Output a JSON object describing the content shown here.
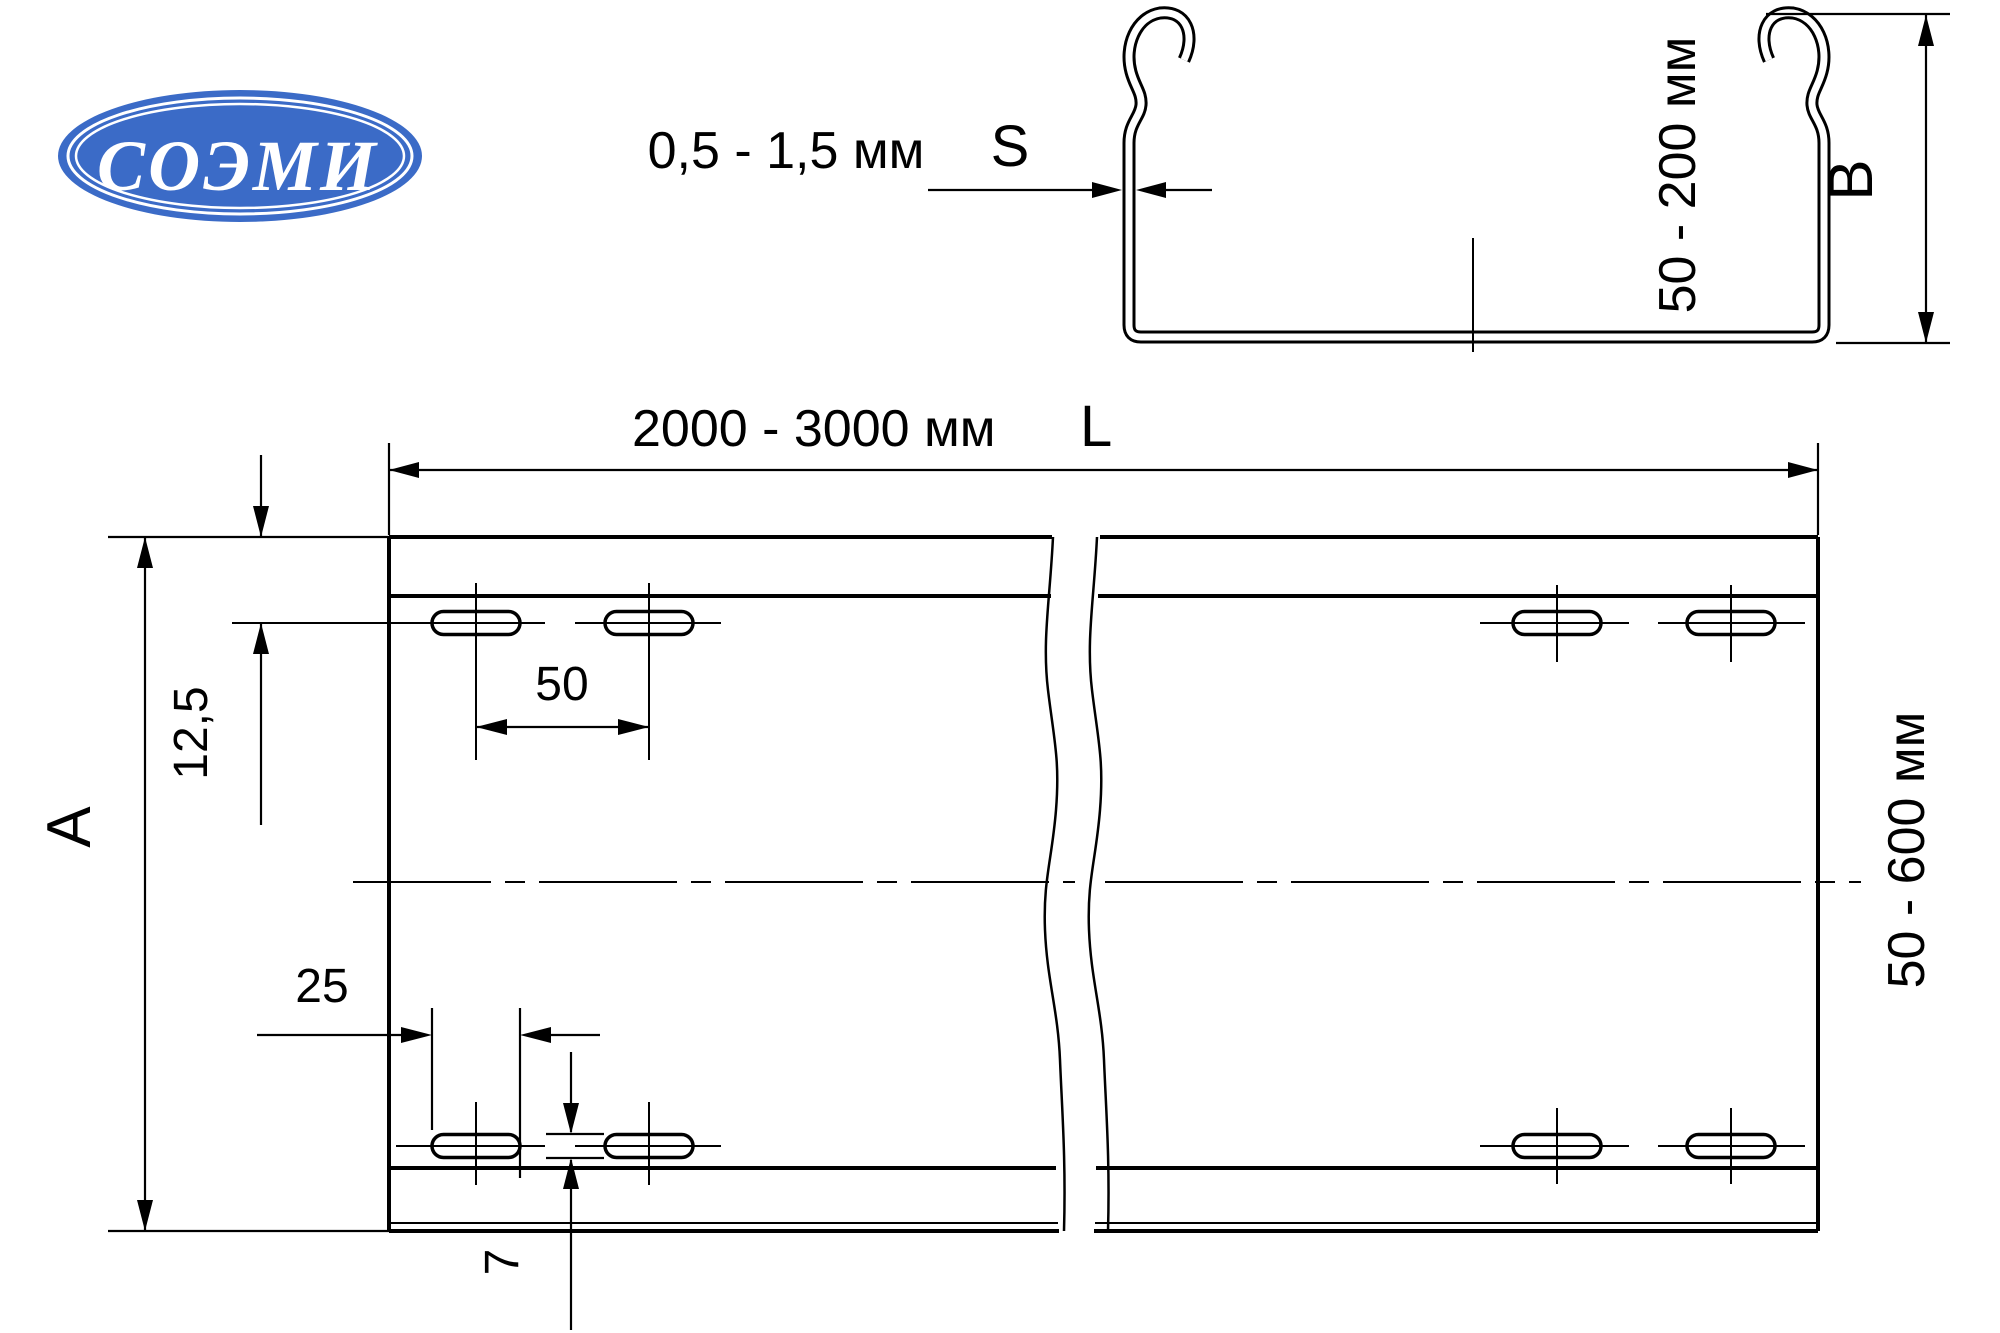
{
  "logo": {
    "text": "СОЭМИ"
  },
  "colors": {
    "logo_blue": "#3b6bc7",
    "line": "#000000",
    "background": "#ffffff"
  },
  "cross_section": {
    "thickness_label": "0,5 - 1,5 мм",
    "thickness_symbol": "S",
    "height_label": "50 - 200 мм",
    "height_symbol": "B"
  },
  "top_view": {
    "length_label": "2000 - 3000 мм",
    "length_symbol": "L",
    "width_symbol": "A",
    "width_label": "50 - 600 мм",
    "edge_offset_label": "12,5",
    "slot_pitch_label": "50",
    "slot_length_label": "25",
    "slot_width_label": "7"
  }
}
